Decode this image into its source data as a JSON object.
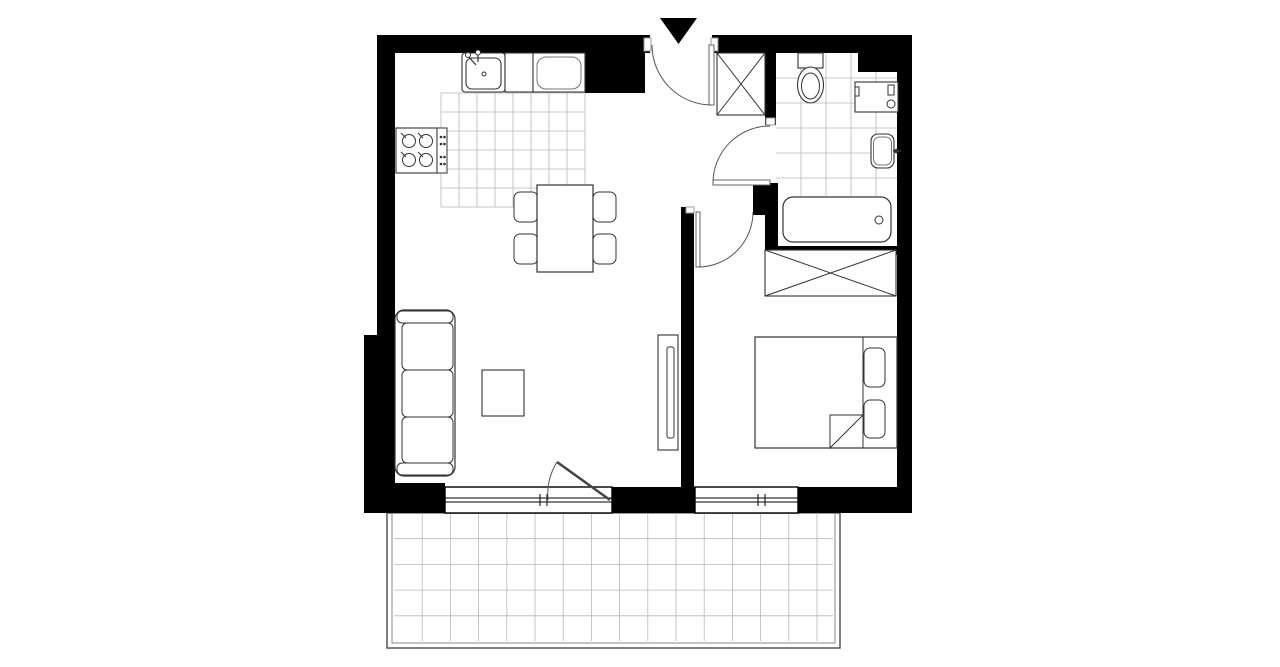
{
  "canvas": {
    "width": 1280,
    "height": 667,
    "background": "#ffffff"
  },
  "colors": {
    "wall": "#000000",
    "furniture_line": "#333333",
    "light_line": "#777777",
    "door_line": "#555555",
    "tile_line": "#b8b8b8",
    "jamb_line": "#999999"
  },
  "shapes": [
    {
      "name": "kitchen-floor-tiles",
      "type": "grid",
      "x": 441,
      "y": 93,
      "w": 144,
      "h": 114,
      "sx": 18,
      "sy": 19,
      "stroke": "#b8b8b8",
      "sw": 0.8,
      "border": true
    },
    {
      "name": "bathroom-floor-tiles",
      "type": "grid",
      "x": 776,
      "y": 53,
      "w": 121,
      "h": 143,
      "sx": 25,
      "sy": 25,
      "stroke": "#b8b8b8",
      "sw": 0.8,
      "border": false
    },
    {
      "name": "balcony-outer-border",
      "type": "rect",
      "x": 387,
      "y": 513,
      "w": 453,
      "h": 135,
      "stroke": "#555555",
      "sw": 1.5
    },
    {
      "name": "balcony-inner-border",
      "type": "rect",
      "x": 392,
      "y": 513,
      "w": 443,
      "h": 130,
      "stroke": "#888888",
      "sw": 1
    },
    {
      "name": "balcony-floor-tiles",
      "type": "grid",
      "x": 394,
      "y": 513,
      "w": 439,
      "h": 128,
      "sx": 28.2,
      "sy": 25.7,
      "stroke": "#b8b8b8",
      "sw": 0.8,
      "border": false
    },
    {
      "name": "top-wall-left",
      "type": "rect",
      "x": 377,
      "y": 35,
      "w": 273,
      "h": 18,
      "fill": "#000000"
    },
    {
      "name": "top-wall-right",
      "type": "rect",
      "x": 712,
      "y": 35,
      "w": 200,
      "h": 18,
      "fill": "#000000"
    },
    {
      "name": "kitchen-corner-wall",
      "type": "rect",
      "x": 585,
      "y": 53,
      "w": 60,
      "h": 40,
      "fill": "#000000"
    },
    {
      "name": "top-right-corner-wall",
      "type": "rect",
      "x": 858,
      "y": 53,
      "w": 54,
      "h": 19,
      "fill": "#000000"
    },
    {
      "name": "left-wall-upper",
      "type": "rect",
      "x": 377,
      "y": 35,
      "w": 18,
      "h": 300,
      "fill": "#000000"
    },
    {
      "name": "left-wall-lower",
      "type": "rect",
      "x": 364,
      "y": 335,
      "w": 31,
      "h": 152,
      "fill": "#000000"
    },
    {
      "name": "bottom-left-corner-wall",
      "type": "rect",
      "x": 364,
      "y": 483,
      "w": 81,
      "h": 30,
      "fill": "#000000"
    },
    {
      "name": "bottom-wall-middle",
      "type": "rect",
      "x": 612,
      "y": 487,
      "w": 83,
      "h": 26,
      "fill": "#000000"
    },
    {
      "name": "bottom-wall-right",
      "type": "rect",
      "x": 798,
      "y": 487,
      "w": 114,
      "h": 26,
      "fill": "#000000"
    },
    {
      "name": "right-wall",
      "type": "rect",
      "x": 897,
      "y": 53,
      "w": 15,
      "h": 460,
      "fill": "#000000"
    },
    {
      "name": "living-bedroom-divider-wall",
      "type": "rect",
      "x": 681,
      "y": 207,
      "w": 13,
      "h": 280,
      "fill": "#000000"
    },
    {
      "name": "hall-bathroom-wall",
      "type": "rect",
      "x": 765,
      "y": 35,
      "w": 11,
      "h": 90,
      "fill": "#000000"
    },
    {
      "name": "bathroom-door-lower-wall",
      "type": "rect",
      "x": 765,
      "y": 183,
      "w": 13,
      "h": 67,
      "fill": "#000000"
    },
    {
      "name": "bedroom-door-jamb-wall",
      "type": "rect",
      "x": 753,
      "y": 183,
      "w": 15,
      "h": 32,
      "fill": "#000000"
    },
    {
      "name": "bathroom-bedroom-wall",
      "type": "rect",
      "x": 765,
      "y": 246,
      "w": 132,
      "h": 9,
      "fill": "#000000"
    },
    {
      "name": "entrance-jamb-left",
      "type": "rect",
      "x": 644,
      "y": 38,
      "w": 7,
      "h": 13,
      "fill": "#ffffff",
      "stroke": "#999999",
      "sw": 1
    },
    {
      "name": "entrance-jamb-right",
      "type": "rect",
      "x": 711,
      "y": 38,
      "w": 7,
      "h": 13,
      "fill": "#ffffff",
      "stroke": "#999999",
      "sw": 1
    },
    {
      "name": "bathroom-door-jamb",
      "type": "rect",
      "x": 766,
      "y": 118,
      "w": 9,
      "h": 7,
      "fill": "#ffffff",
      "stroke": "#999999",
      "sw": 1
    },
    {
      "name": "bedroom-door-jamb",
      "type": "rect",
      "x": 686,
      "y": 207,
      "w": 8,
      "h": 6,
      "fill": "#ffffff",
      "stroke": "#999999",
      "sw": 1
    },
    {
      "name": "living-window-frame",
      "type": "rect",
      "x": 445,
      "y": 487,
      "w": 167,
      "h": 26,
      "fill": "#ffffff",
      "stroke": "#000000",
      "sw": 1.4
    },
    {
      "name": "living-window-glass-line-1",
      "type": "line",
      "x1": 445,
      "y1": 498,
      "x2": 612,
      "y2": 498,
      "stroke": "#000000",
      "sw": 1
    },
    {
      "name": "living-window-glass-line-2",
      "type": "line",
      "x1": 445,
      "y1": 502,
      "x2": 612,
      "y2": 502,
      "stroke": "#000000",
      "sw": 1
    },
    {
      "name": "living-window-mullion-1",
      "type": "line",
      "x1": 540,
      "y1": 494,
      "x2": 540,
      "y2": 506,
      "stroke": "#000000",
      "sw": 1
    },
    {
      "name": "living-window-mullion-2",
      "type": "line",
      "x1": 547,
      "y1": 494,
      "x2": 547,
      "y2": 506,
      "stroke": "#000000",
      "sw": 1
    },
    {
      "name": "bedroom-window-frame",
      "type": "rect",
      "x": 695,
      "y": 487,
      "w": 103,
      "h": 26,
      "fill": "#ffffff",
      "stroke": "#000000",
      "sw": 1.4
    },
    {
      "name": "bedroom-window-glass-line-1",
      "type": "line",
      "x1": 695,
      "y1": 498,
      "x2": 798,
      "y2": 498,
      "stroke": "#000000",
      "sw": 1
    },
    {
      "name": "bedroom-window-glass-line-2",
      "type": "line",
      "x1": 695,
      "y1": 502,
      "x2": 798,
      "y2": 502,
      "stroke": "#000000",
      "sw": 1
    },
    {
      "name": "bedroom-window-mullion-1",
      "type": "line",
      "x1": 758,
      "y1": 494,
      "x2": 758,
      "y2": 506,
      "stroke": "#000000",
      "sw": 1
    },
    {
      "name": "bedroom-window-mullion-2",
      "type": "line",
      "x1": 765,
      "y1": 494,
      "x2": 765,
      "y2": 506,
      "stroke": "#000000",
      "sw": 1
    },
    {
      "name": "kitchen-sink-counter",
      "type": "rrect",
      "x": 462,
      "y": 53,
      "w": 43,
      "h": 39,
      "rx": 3,
      "fill": "#ffffff",
      "stroke": "#333333",
      "sw": 1.1
    },
    {
      "name": "kitchen-sink-basin",
      "type": "rrect",
      "x": 466,
      "y": 58,
      "w": 35,
      "h": 31,
      "rx": 6,
      "fill": "#ffffff",
      "stroke": "#333333",
      "sw": 1.1
    },
    {
      "name": "kitchen-sink-faucet",
      "type": "path",
      "d": "M468 56 L476 65 M478 53 L478 62",
      "stroke": "#333333",
      "sw": 1.2
    },
    {
      "name": "kitchen-faucet-knob-1",
      "type": "circle",
      "cx": 468,
      "cy": 55,
      "r": 2.5,
      "fill": "#ffffff",
      "stroke": "#333333",
      "sw": 1
    },
    {
      "name": "kitchen-faucet-knob-2",
      "type": "circle",
      "cx": 478,
      "cy": 52.5,
      "r": 2.5,
      "fill": "#ffffff",
      "stroke": "#333333",
      "sw": 1
    },
    {
      "name": "kitchen-sink-drain",
      "type": "circle",
      "cx": 484,
      "cy": 74,
      "r": 2,
      "fill": "#ffffff",
      "stroke": "#333333",
      "sw": 1
    },
    {
      "name": "kitchen-counter",
      "type": "rect",
      "x": 505,
      "y": 53,
      "w": 28,
      "h": 39,
      "fill": "#ffffff",
      "stroke": "#333333",
      "sw": 1.1
    },
    {
      "name": "kitchen-fridge",
      "type": "rect",
      "x": 533,
      "y": 53,
      "w": 52,
      "h": 39,
      "fill": "#ffffff",
      "stroke": "#333333",
      "sw": 1.1
    },
    {
      "name": "kitchen-fridge-inner",
      "type": "rrect",
      "x": 537,
      "y": 57,
      "w": 44,
      "h": 32,
      "rx": 9,
      "fill": "none",
      "stroke": "#777777",
      "sw": 1
    },
    {
      "name": "kitchen-stove",
      "type": "rect",
      "x": 396,
      "y": 128,
      "w": 41,
      "h": 45,
      "fill": "#ffffff",
      "stroke": "#333333",
      "sw": 1.1
    },
    {
      "name": "stove-burner-1",
      "type": "circle",
      "cx": 409,
      "cy": 141,
      "r": 6.5,
      "fill": "none",
      "stroke": "#333333",
      "sw": 1
    },
    {
      "name": "stove-burner-2",
      "type": "circle",
      "cx": 426,
      "cy": 141,
      "r": 6.5,
      "fill": "none",
      "stroke": "#333333",
      "sw": 1
    },
    {
      "name": "stove-burner-3",
      "type": "circle",
      "cx": 409,
      "cy": 160,
      "r": 6.5,
      "fill": "none",
      "stroke": "#333333",
      "sw": 1
    },
    {
      "name": "stove-burner-4",
      "type": "circle",
      "cx": 426,
      "cy": 160,
      "r": 6.5,
      "fill": "none",
      "stroke": "#333333",
      "sw": 1
    },
    {
      "name": "stove-burner-ticks",
      "type": "path",
      "d": "M401 133 L406 138 M418 133 L423 138 M401 152 L406 157 M418 152 L423 157",
      "stroke": "#333333",
      "sw": 1
    },
    {
      "name": "stove-control-panel",
      "type": "rect",
      "x": 437,
      "y": 128,
      "w": 10,
      "h": 45,
      "fill": "#ffffff",
      "stroke": "#333333",
      "sw": 1
    },
    {
      "name": "stove-control-knobs",
      "type": "dots",
      "r": 1.3,
      "fill": "#333333",
      "pts": [
        [
          441,
          137
        ],
        [
          444.5,
          137
        ],
        [
          441,
          144
        ],
        [
          444.5,
          144
        ],
        [
          441,
          157
        ],
        [
          444.5,
          157
        ],
        [
          441,
          164
        ],
        [
          444.5,
          164
        ]
      ]
    },
    {
      "name": "hall-wardrobe",
      "type": "rect",
      "x": 717,
      "y": 53,
      "w": 48,
      "h": 62,
      "fill": "#ffffff",
      "stroke": "#333333",
      "sw": 1.1
    },
    {
      "name": "hall-wardrobe-cross",
      "type": "path",
      "d": "M717 53 L765 115 M765 53 L717 115",
      "stroke": "#333333",
      "sw": 1
    },
    {
      "name": "toilet-tank",
      "type": "rect",
      "x": 798,
      "y": 53,
      "w": 25,
      "h": 15,
      "fill": "#ffffff",
      "stroke": "#333333",
      "sw": 1.1
    },
    {
      "name": "toilet-bowl-outer",
      "type": "ellipse",
      "cx": 810.5,
      "cy": 85,
      "rx": 13,
      "ry": 18,
      "fill": "#ffffff",
      "stroke": "#333333",
      "sw": 1.1
    },
    {
      "name": "toilet-bowl-inner",
      "type": "ellipse",
      "cx": 810.5,
      "cy": 86,
      "rx": 9,
      "ry": 13,
      "fill": "none",
      "stroke": "#333333",
      "sw": 1
    },
    {
      "name": "washing-machine",
      "type": "rect",
      "x": 855,
      "y": 82,
      "w": 43,
      "h": 30,
      "fill": "#ffffff",
      "stroke": "#333333",
      "sw": 1.1
    },
    {
      "name": "washing-machine-door-tick",
      "type": "rect",
      "x": 855,
      "y": 87,
      "w": 4,
      "h": 9,
      "fill": "#ffffff",
      "stroke": "#333333",
      "sw": 1
    },
    {
      "name": "washing-machine-drawer",
      "type": "rect",
      "x": 888,
      "y": 85,
      "w": 6,
      "h": 10,
      "fill": "#ffffff",
      "stroke": "#333333",
      "sw": 1
    },
    {
      "name": "washing-machine-knob",
      "type": "circle",
      "cx": 891,
      "cy": 104,
      "r": 4,
      "fill": "#ffffff",
      "stroke": "#333333",
      "sw": 1
    },
    {
      "name": "bathroom-sink",
      "type": "rrect",
      "x": 871,
      "y": 134,
      "w": 23,
      "h": 34,
      "rx": 7,
      "fill": "#ffffff",
      "stroke": "#333333",
      "sw": 1.1
    },
    {
      "name": "bathroom-sink-inner",
      "type": "rrect",
      "x": 873.5,
      "y": 137,
      "w": 18,
      "h": 28,
      "rx": 6,
      "fill": "none",
      "stroke": "#777777",
      "sw": 1
    },
    {
      "name": "bathroom-sink-faucet",
      "type": "line",
      "x1": 893,
      "y1": 151,
      "x2": 901,
      "y2": 151,
      "stroke": "#333333",
      "sw": 1.5
    },
    {
      "name": "bathroom-sink-faucet-knob",
      "type": "circle",
      "cx": 896.5,
      "cy": 151,
      "r": 2.3,
      "fill": "#333333"
    },
    {
      "name": "bathtub",
      "type": "rrect",
      "x": 783,
      "y": 197,
      "w": 108,
      "h": 45,
      "rx": 10,
      "fill": "#ffffff",
      "stroke": "#333333",
      "sw": 1.2
    },
    {
      "name": "bathtub-drain",
      "type": "circle",
      "cx": 879,
      "cy": 220,
      "r": 4,
      "fill": "#ffffff",
      "stroke": "#333333",
      "sw": 1
    },
    {
      "name": "bedroom-wardrobe",
      "type": "rect",
      "x": 765,
      "y": 250,
      "w": 131,
      "h": 46,
      "fill": "#ffffff",
      "stroke": "#333333",
      "sw": 1.1
    },
    {
      "name": "bedroom-wardrobe-cross",
      "type": "path",
      "d": "M765 250 L896 296 M896 250 L765 296",
      "stroke": "#333333",
      "sw": 1
    },
    {
      "name": "bed",
      "type": "rect",
      "x": 755,
      "y": 337,
      "w": 142,
      "h": 111,
      "fill": "#ffffff",
      "stroke": "#333333",
      "sw": 1.2
    },
    {
      "name": "bed-headboard-line",
      "type": "line",
      "x1": 863,
      "y1": 337,
      "x2": 863,
      "y2": 448,
      "stroke": "#333333",
      "sw": 1
    },
    {
      "name": "bed-pillow-1",
      "type": "rrect",
      "x": 864,
      "y": 348,
      "w": 21,
      "h": 39,
      "rx": 6,
      "fill": "#ffffff",
      "stroke": "#333333",
      "sw": 1
    },
    {
      "name": "bed-pillow-2",
      "type": "rrect",
      "x": 864,
      "y": 400,
      "w": 21,
      "h": 38,
      "rx": 6,
      "fill": "#ffffff",
      "stroke": "#333333",
      "sw": 1
    },
    {
      "name": "bed-blanket-fold",
      "type": "path",
      "d": "M830 448 L830 415 L863 415 L830 448 Z",
      "fill": "#ffffff",
      "stroke": "#333333",
      "sw": 1
    },
    {
      "name": "tv-cabinet",
      "type": "rect",
      "x": 658,
      "y": 335,
      "w": 20,
      "h": 115,
      "fill": "#ffffff",
      "stroke": "#333333",
      "sw": 1.1
    },
    {
      "name": "tv-screen",
      "type": "rrect",
      "x": 667,
      "y": 347,
      "w": 7,
      "h": 91,
      "rx": 2,
      "fill": "#ffffff",
      "stroke": "#333333",
      "sw": 1
    },
    {
      "name": "sofa-body",
      "type": "rrect",
      "x": 395,
      "y": 310,
      "w": 60,
      "h": 166,
      "rx": 9,
      "fill": "#ffffff",
      "stroke": "#333333",
      "sw": 1.2
    },
    {
      "name": "sofa-armrest-top",
      "type": "rrect",
      "x": 397,
      "y": 311,
      "w": 56,
      "h": 12,
      "rx": 5,
      "fill": "#ffffff",
      "stroke": "#333333",
      "sw": 1
    },
    {
      "name": "sofa-armrest-bottom",
      "type": "rrect",
      "x": 397,
      "y": 463,
      "w": 56,
      "h": 12,
      "rx": 5,
      "fill": "#ffffff",
      "stroke": "#333333",
      "sw": 1
    },
    {
      "name": "sofa-seat-1",
      "type": "rrect",
      "x": 402,
      "y": 323,
      "w": 51,
      "h": 47,
      "rx": 5,
      "fill": "#ffffff",
      "stroke": "#333333",
      "sw": 1
    },
    {
      "name": "sofa-seat-2",
      "type": "rrect",
      "x": 402,
      "y": 370,
      "w": 51,
      "h": 47,
      "rx": 5,
      "fill": "#ffffff",
      "stroke": "#333333",
      "sw": 1
    },
    {
      "name": "sofa-seat-3",
      "type": "rrect",
      "x": 402,
      "y": 417,
      "w": 51,
      "h": 46,
      "rx": 5,
      "fill": "#ffffff",
      "stroke": "#333333",
      "sw": 1
    },
    {
      "name": "coffee-table",
      "type": "rect",
      "x": 482,
      "y": 370,
      "w": 42,
      "h": 46,
      "fill": "#ffffff",
      "stroke": "#333333",
      "sw": 1.1
    },
    {
      "name": "dining-chair-1",
      "type": "rrect",
      "x": 514,
      "y": 192,
      "w": 24,
      "h": 30,
      "rx": 6,
      "fill": "#ffffff",
      "stroke": "#333333",
      "sw": 1
    },
    {
      "name": "dining-chair-2",
      "type": "rrect",
      "x": 514,
      "y": 234,
      "w": 24,
      "h": 30,
      "rx": 6,
      "fill": "#ffffff",
      "stroke": "#333333",
      "sw": 1
    },
    {
      "name": "dining-chair-3",
      "type": "rrect",
      "x": 593,
      "y": 192,
      "w": 23,
      "h": 30,
      "rx": 6,
      "fill": "#ffffff",
      "stroke": "#333333",
      "sw": 1
    },
    {
      "name": "dining-chair-4",
      "type": "rrect",
      "x": 593,
      "y": 234,
      "w": 23,
      "h": 30,
      "rx": 6,
      "fill": "#ffffff",
      "stroke": "#333333",
      "sw": 1
    },
    {
      "name": "dining-table",
      "type": "rect",
      "x": 537,
      "y": 185,
      "w": 56,
      "h": 87,
      "fill": "#ffffff",
      "stroke": "#333333",
      "sw": 1.2
    },
    {
      "name": "entrance-door-leaf",
      "type": "rect",
      "x": 709,
      "y": 45,
      "w": 5,
      "h": 60,
      "fill": "#ffffff",
      "stroke": "#666666",
      "sw": 1
    },
    {
      "name": "entrance-door-arc",
      "type": "path",
      "d": "M652 45 A60 60 0 0 0 712 105",
      "fill": "none",
      "stroke": "#555555",
      "sw": 1
    },
    {
      "name": "bathroom-door-leaf",
      "type": "rect",
      "x": 713,
      "y": 180,
      "w": 57,
      "h": 5,
      "fill": "#ffffff",
      "stroke": "#666666",
      "sw": 1
    },
    {
      "name": "bathroom-door-arc",
      "type": "path",
      "d": "M713 183 A57 57 0 0 1 770 126",
      "fill": "none",
      "stroke": "#555555",
      "sw": 1
    },
    {
      "name": "bedroom-door-leaf",
      "type": "rect",
      "x": 696,
      "y": 212,
      "w": 4,
      "h": 55,
      "fill": "#ffffff",
      "stroke": "#666666",
      "sw": 1
    },
    {
      "name": "bedroom-door-arc",
      "type": "path",
      "d": "M698 267 A55 55 0 0 0 753 212",
      "fill": "none",
      "stroke": "#555555",
      "sw": 1
    },
    {
      "name": "balcony-door-leaf",
      "type": "line",
      "x1": 610,
      "y1": 500,
      "x2": 557,
      "y2": 462,
      "stroke": "#444444",
      "sw": 2.5
    },
    {
      "name": "balcony-door-arc",
      "type": "path",
      "d": "M548 500 A62 62 0 0 1 557 462",
      "fill": "none",
      "stroke": "#555555",
      "sw": 1
    },
    {
      "name": "entrance-marker-triangle",
      "type": "polygon",
      "points": "660,18 697,18 678.5,44",
      "fill": "#000000"
    }
  ]
}
